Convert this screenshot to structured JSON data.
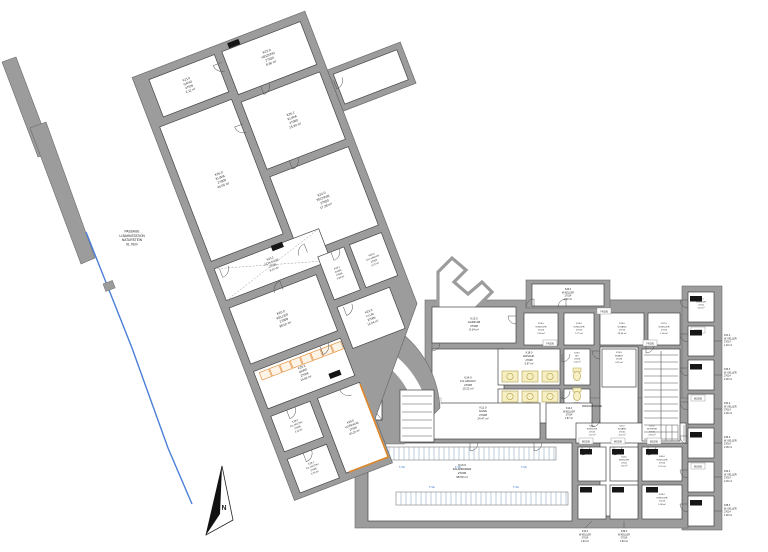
{
  "colors": {
    "wall": "#9c9c9c",
    "wall_edge": "#6b6b6b",
    "room": "#ffffff",
    "line": "#444444",
    "text": "#1c1c1c",
    "yellow": "#f6efc3",
    "yellow_edge": "#b5a14b",
    "orange": "#e0862a",
    "blue": "#4a7fd6",
    "rack": "#7d98b8",
    "black_tag": "#161616"
  },
  "rotated_wing": {
    "angle": -21,
    "pivot": [
      135,
      85
    ],
    "silhouette": "135,77 320,77 320,390 240,482 240,530 135,530",
    "stub": "320,140 398,140 398,184 320,184",
    "stub_room": [
      324,
      146,
      68,
      32
    ],
    "rooms": [
      {
        "id": "K21.0",
        "lines": [
          "K21.0",
          "GANG",
          "27026",
          "2.12 m²"
        ],
        "rect": [
          150,
          85,
          70,
          40
        ],
        "fs": 3.0
      },
      {
        "id": "K22.0",
        "lines": [
          "K22.0",
          "HEIZUNG",
          "27020",
          "8.36 m²"
        ],
        "rect": [
          228,
          85,
          84,
          46
        ],
        "fs": 3.2
      },
      {
        "id": "K26.1",
        "lines": [
          "K26.1",
          "KLIMA",
          "27000",
          "15.34 m²"
        ],
        "rect": [
          228,
          139,
          84,
          72
        ],
        "fs": 3.2
      },
      {
        "id": "K26.0",
        "lines": [
          "K26.0",
          "KLIMA",
          "27000",
          "46.06 m²"
        ],
        "rect": [
          143,
          133,
          77,
          144
        ],
        "fs": 3.2
      },
      {
        "id": "K24.0",
        "lines": [
          "K24.0",
          "TECHNIK",
          "27000",
          "17.28 m²"
        ],
        "rect": [
          228,
          219,
          84,
          84
        ],
        "fs": 3.2
      },
      {
        "id": "K23.2",
        "lines": [
          "K23.2",
          "SCHLEUSE",
          "27026",
          "8.37 m²"
        ],
        "rect": [
          143,
          285,
          112,
          34
        ],
        "fs": 2.8,
        "cross": true
      },
      {
        "id": "K23.1",
        "lines": [
          "K23.1",
          "GANG",
          "27026",
          "3.66 m²"
        ],
        "rect": [
          244,
          311,
          28,
          46
        ],
        "fs": 2.4
      },
      {
        "id": "K25.0",
        "lines": [
          "K25.0",
          "KLT.ARCHIV",
          "27005",
          "9.37 m²"
        ],
        "rect": [
          278,
          311,
          34,
          46
        ],
        "fs": 2.4
      },
      {
        "id": "K23.0",
        "lines": [
          "K23.0",
          "FLUR",
          "27006",
          "14.04 m²"
        ],
        "rect": [
          244,
          365,
          56,
          44
        ],
        "fs": 3.0
      },
      {
        "id": "K20.0",
        "lines": [
          "K20.0",
          "KELLER",
          "27008",
          "38.62 m²"
        ],
        "rect": [
          143,
          327,
          93,
          60
        ],
        "fs": 3.2
      },
      {
        "id": "K20.2",
        "lines": [
          "K20.2",
          "GARD",
          "27008",
          "14.62 m²"
        ],
        "rect": [
          143,
          395,
          93,
          40
        ],
        "fs": 3.0
      },
      {
        "id": "K28.0",
        "lines": [
          "K28.0",
          "FIL.ARCHIV",
          "27006",
          "4.10 m²"
        ],
        "rect": [
          143,
          443,
          42,
          38
        ],
        "fs": 2.4
      },
      {
        "id": "K28.1",
        "lines": [
          "K28.1",
          "FIL.ARCHIV",
          "27006",
          "4.76 m²"
        ],
        "rect": [
          143,
          489,
          42,
          36
        ],
        "fs": 2.4
      },
      {
        "id": "K29.0",
        "lines": [
          "K29.0",
          "VORRAUM",
          "27026",
          "20.20 m²"
        ],
        "rect": [
          193,
          443,
          45,
          80
        ],
        "fs": 2.8
      }
    ],
    "shelf": {
      "x": 148,
      "y": 398,
      "n": 8,
      "w": 10,
      "h": 8,
      "dx": 11
    },
    "orange_line": "238,445 238,523 196,523",
    "doors": [
      [
        224,
        95,
        90
      ],
      [
        252,
        131,
        0
      ],
      [
        252,
        211,
        0
      ],
      [
        222,
        160,
        90
      ],
      [
        148,
        287,
        0
      ],
      [
        236,
        303,
        180
      ],
      [
        258,
        311,
        0
      ],
      [
        200,
        329,
        180
      ],
      [
        250,
        367,
        0
      ],
      [
        214,
        395,
        0
      ],
      [
        226,
        443,
        90
      ],
      [
        160,
        443,
        0
      ],
      [
        160,
        489,
        0
      ],
      [
        322,
        152,
        0
      ]
    ],
    "black_boxes": [
      [
        236,
        79
      ],
      [
        204,
        284
      ],
      [
        212,
        424
      ]
    ]
  },
  "hub": {
    "silhouette_path": "M 312,318 L 344,310 A 104,104 0 0 1 440,408 L 404,444 L 356,444 L 312,397 Z",
    "arc_band": {
      "d": "M 334,340 A 90,90 0 0 1 424,430",
      "width": 13
    },
    "steps": [
      [
        334,
        352,
        334,
        336
      ],
      [
        345,
        353,
        347,
        337
      ],
      [
        356,
        355,
        360,
        340
      ],
      [
        366,
        359,
        372,
        344
      ],
      [
        375,
        364,
        383,
        350
      ]
    ],
    "lift": {
      "rect": [
        352,
        382,
        30,
        38
      ],
      "lines": [
        "LIFT",
        "27008",
        "4.35 m²"
      ],
      "fs": 2.6
    },
    "abst": {
      "rect": [
        318,
        348,
        26,
        24
      ],
      "lines": [
        "K30.0",
        "ABST",
        "27005",
        "2.30 m²"
      ],
      "fs": 2.2
    },
    "ministair": {
      "rect": [
        400,
        390,
        34,
        52
      ],
      "step": 8
    }
  },
  "ortho": {
    "silhouettes": [
      [
        425,
        300,
        280,
        125
      ],
      [
        600,
        300,
        88,
        222
      ],
      [
        682,
        286,
        40,
        244
      ],
      [
        526,
        280,
        84,
        28
      ],
      [
        355,
        398,
        333,
        130
      ]
    ],
    "rooms": [
      {
        "id": "K13.0",
        "lines": [
          "K13.0",
          "GARD.AB",
          "27008",
          "8.14 m²"
        ],
        "rect": [
          432,
          307,
          84,
          36
        ],
        "fs": 2.8
      },
      {
        "id": "K14.0",
        "lines": [
          "K14.0",
          "FIL.ARCHIV",
          "27008",
          "15.22 m²"
        ],
        "rect": [
          432,
          349,
          72,
          70
        ],
        "fs": 2.8
      },
      {
        "id": "K26.0b",
        "lines": [
          "K26.0",
          "W.KELLER",
          "27014",
          "2.02 m²"
        ],
        "rect": [
          532,
          284,
          72,
          22
        ],
        "fs": 2.4
      },
      {
        "id": "K25.0b",
        "lines": [
          "K25.0",
          "W.KELLER",
          "27014",
          "2.00 m²"
        ],
        "rect": [
          524,
          313,
          34,
          32
        ],
        "fs": 2.2
      },
      {
        "id": "K24.0b",
        "lines": [
          "K24.0",
          "W.KELLER",
          "27014",
          "1.72 m²"
        ],
        "rect": [
          564,
          313,
          30,
          32
        ],
        "fs": 2.2
      },
      {
        "id": "K27.0",
        "lines": [
          "K27.0",
          "W.KELLER",
          "27014",
          "1.48 m²"
        ],
        "rect": [
          648,
          313,
          32,
          32
        ],
        "fs": 2.2
      },
      {
        "id": "K29.0b",
        "lines": [
          "K29.0",
          "W.GANG",
          "27010",
          "28.30 m²"
        ],
        "rect": [
          600,
          313,
          44,
          32
        ],
        "fs": 2.2
      },
      {
        "id": "corridor-v",
        "lines": [],
        "rect": [
          600,
          347,
          38,
          169
        ]
      },
      {
        "id": "K18.0",
        "lines": [
          "K18.0",
          "WASCHK.",
          "27028",
          "5.97 m²"
        ],
        "rect": [
          498,
          349,
          62,
          36
        ],
        "fs": 2.6,
        "lc": [
          529,
          359
        ]
      },
      {
        "id": "K17.0",
        "lines": [
          "K17.0",
          "WASCHK.",
          "27028",
          "4.26 m²"
        ],
        "rect": [
          498,
          389,
          62,
          34
        ],
        "fs": 2.6,
        "lc": [
          529,
          408
        ]
      },
      {
        "id": "K19.0",
        "lines": [
          "K19.0",
          "WC",
          "27028",
          "1.42 m²"
        ],
        "rect": [
          564,
          349,
          26,
          36
        ],
        "fs": 2.1,
        "lc": [
          577,
          358
        ]
      },
      {
        "id": "K16.0",
        "lines": [
          "K16.0",
          "WC",
          "27028",
          "1.42 m²"
        ],
        "rect": [
          564,
          389,
          26,
          34
        ],
        "fs": 2.1,
        "lc": [
          577,
          408
        ]
      },
      {
        "id": "K11.0",
        "lines": [
          "K11.0",
          "GANG",
          "27008",
          "24.47 m²"
        ],
        "rect": [
          430,
          403,
          110,
          36
        ],
        "fs": 2.8,
        "lc": [
          483,
          414
        ]
      },
      {
        "id": "K12.0",
        "lines": [
          "K12.0",
          "W.KELLER",
          "27014",
          "1.87 m²"
        ],
        "rect": [
          546,
          403,
          46,
          36
        ],
        "fs": 2.4,
        "lc": [
          569,
          414
        ]
      },
      {
        "id": "K10.0",
        "lines": [
          "K10.0",
          "FAHRRÄDER",
          "27006",
          "38.50 m²"
        ],
        "rect": [
          368,
          443,
          204,
          78
        ],
        "fs": 3.0,
        "lc": [
          462,
          472
        ]
      },
      {
        "id": "strip",
        "lines": [],
        "rect": [
          576,
          423,
          110,
          20
        ]
      },
      {
        "id": "stairwell",
        "lines": [],
        "rect": [
          642,
          349,
          38,
          92
        ]
      }
    ],
    "k15": {
      "rect": [
        602,
        349,
        34,
        38
      ],
      "lines": [
        "K15.0",
        "W.ABST",
        "27028",
        "4.31 m²"
      ],
      "fs": 2.2,
      "lc": [
        619,
        358
      ]
    },
    "waschkueche_text": {
      "pos": [
        592,
        407
      ],
      "text": "WASCHKÜCHE",
      "fs": 2.8
    },
    "strip_labels": [
      {
        "lc": [
          592,
          431
        ],
        "lines": [
          "K40.0",
          "W.KELLER",
          "27014",
          "1.57 m²"
        ],
        "fs": 2.1
      },
      {
        "lc": [
          622,
          431
        ],
        "lines": [
          "K41.0",
          "W.GANG",
          "27010",
          "4.22 m²"
        ],
        "fs": 2.1
      },
      {
        "lc": [
          652,
          431
        ],
        "lines": [
          "K37.0",
          "W.STIEGE",
          "27010",
          "4.94 m²"
        ],
        "fs": 2.1
      }
    ],
    "ministeps_x": [
      666,
      672,
      678,
      684
    ],
    "cells_br": [
      {
        "rect": [
          578,
          447,
          28,
          34
        ]
      },
      {
        "rect": [
          610,
          447,
          28,
          34
        ],
        "lines": [
          "K45.0",
          "W.KELLER",
          "27014",
          "1.92 m²"
        ],
        "fs": 2.0,
        "lc": [
          624,
          462
        ]
      },
      {
        "rect": [
          642,
          447,
          40,
          34
        ],
        "lines": [
          "K44.0",
          "W.KELLER",
          "27014",
          "2.37 m²"
        ],
        "fs": 2.2,
        "lc": [
          662,
          462
        ]
      },
      {
        "rect": [
          578,
          485,
          28,
          34
        ]
      },
      {
        "rect": [
          610,
          485,
          28,
          34
        ]
      },
      {
        "rect": [
          642,
          485,
          40,
          34
        ],
        "lines": [
          "K43.0",
          "W.KELLER",
          "27014",
          "1.88 m²"
        ],
        "fs": 2.2,
        "lc": [
          662,
          500
        ]
      }
    ],
    "cells_right": {
      "x": 688,
      "y": 292,
      "w": 26,
      "h": 30,
      "dy": 34,
      "n": 7
    },
    "cell_right_first_label": {
      "lc": [
        701,
        304
      ],
      "lines": [
        "K30.0",
        "W.KELLER",
        "27014",
        "2.18 m²"
      ],
      "fs": 2.0
    },
    "leaders_right": [
      {
        "y": 341,
        "lines": [
          "K31.0",
          "W. KELLER",
          "27014",
          "1.20 m²"
        ]
      },
      {
        "y": 375,
        "lines": [
          "K33.0",
          "W. KELLER",
          "27014",
          "2.06 m²"
        ]
      },
      {
        "y": 409,
        "lines": [
          "K34.0",
          "W. KELLER",
          "27014",
          "2.06 m²"
        ]
      },
      {
        "y": 443,
        "lines": [
          "K36.0",
          "W. KELLER",
          "27014",
          "2.06 m²"
        ]
      },
      {
        "y": 477,
        "lines": [
          "K32.0",
          "W. KELLER",
          "27014",
          "2.26 m²"
        ]
      },
      {
        "y": 511,
        "lines": [
          "K38.0",
          "W. KELLER",
          "27014",
          "1.90 m²"
        ]
      }
    ],
    "leaders_bottom": [
      {
        "cell_x": 592,
        "label_x": 585,
        "lines": [
          "K42.0",
          "W.KELLER",
          "27014",
          "1.63 m²"
        ]
      },
      {
        "cell_x": 624,
        "label_x": 624,
        "lines": [
          "K39.0",
          "W.KELLER",
          "27014",
          "1.83 m²"
        ]
      }
    ],
    "stairs": {
      "rect": [
        642,
        349,
        38,
        92
      ],
      "step": 7
    },
    "racks": {
      "bands": [
        [
          384,
          447,
          172,
          13
        ],
        [
          396,
          492,
          172,
          13
        ]
      ],
      "step": 5,
      "labels": [
        [
          402,
          468
        ],
        [
          458,
          468
        ],
        [
          524,
          468
        ],
        [
          432,
          488
        ],
        [
          516,
          488
        ]
      ],
      "label_text": "5 Stk"
    },
    "machines": [
      [
        502,
        371
      ],
      [
        522,
        371
      ],
      [
        542,
        371
      ],
      [
        502,
        391
      ],
      [
        522,
        391
      ],
      [
        542,
        391
      ]
    ],
    "toilets": [
      [
        577,
        376
      ],
      [
        577,
        396
      ]
    ],
    "doors": [
      [
        516,
        316,
        90
      ],
      [
        562,
        354,
        0
      ],
      [
        562,
        391,
        0
      ],
      [
        600,
        351,
        90
      ],
      [
        646,
        345,
        0
      ],
      [
        534,
        307,
        180
      ],
      [
        566,
        307,
        180
      ],
      [
        592,
        419,
        0
      ],
      [
        470,
        443,
        0
      ],
      [
        534,
        443,
        0
      ],
      [
        432,
        343,
        0
      ],
      [
        582,
        447,
        0
      ],
      [
        614,
        447,
        0
      ],
      [
        648,
        447,
        0
      ],
      [
        688,
        300,
        90
      ],
      [
        688,
        334,
        90
      ],
      [
        688,
        368,
        90
      ],
      [
        688,
        402,
        90
      ],
      [
        688,
        436,
        90
      ],
      [
        688,
        470,
        90
      ],
      [
        688,
        504,
        90
      ]
    ],
    "tags": [
      [
        586,
        441,
        "80/200"
      ],
      [
        618,
        441,
        "80/200"
      ],
      [
        654,
        441,
        "80/200"
      ],
      [
        698,
        330,
        "80/200"
      ],
      [
        698,
        398,
        "80/200"
      ],
      [
        698,
        466,
        "80/200"
      ],
      [
        650,
        343,
        "74/200"
      ],
      [
        604,
        311,
        "74/200"
      ],
      [
        550,
        343,
        "74/200"
      ],
      [
        434,
        401,
        "90/200"
      ]
    ],
    "black_boxes": [
      [
        580,
        449
      ],
      [
        612,
        449
      ],
      [
        646,
        449
      ],
      [
        580,
        487
      ],
      [
        612,
        487
      ],
      [
        646,
        487
      ],
      [
        690,
        296
      ],
      [
        690,
        330
      ],
      [
        690,
        364
      ],
      [
        690,
        432
      ],
      [
        690,
        500
      ]
    ]
  },
  "notch": "438,308 438,272 452,258 466,270 454,282 468,294 482,282 492,292 470,314",
  "passage": {
    "strips": [
      "2,62 16,57 52,152 38,157",
      "30,128 46,122 95,258 81,264"
    ],
    "blue_line": "86,232 132,348 168,448 192,504",
    "box": [
      103,
      284
    ],
    "text": {
      "pos": [
        118,
        232
      ],
      "lines": [
        "PASSAGE",
        "U-BAHNSTATION",
        "NATURSTEIN",
        "91.76m²"
      ],
      "fs": 3.2
    }
  },
  "north_arrow": {
    "outline": "222,466 206,535 233,520",
    "dark": "222,466 206,535 220,514",
    "letter": "N",
    "pos": [
      224,
      510
    ]
  }
}
